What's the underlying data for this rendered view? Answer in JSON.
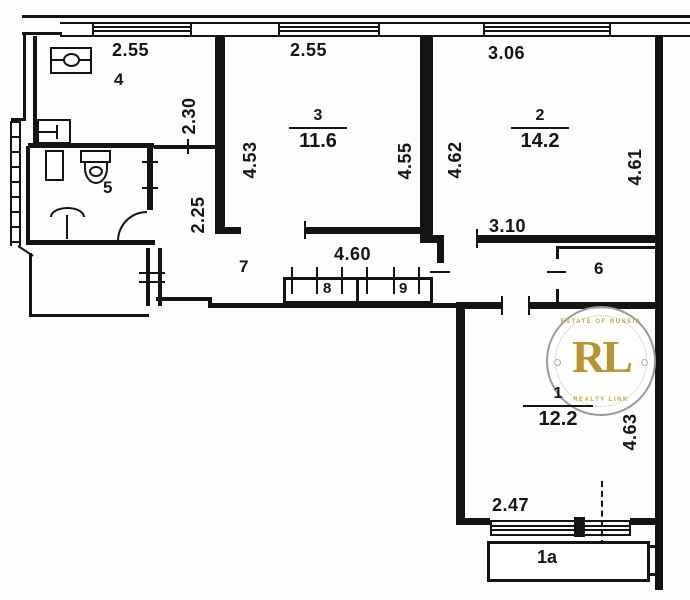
{
  "colors": {
    "ink": "#141414",
    "watermark_gold": "#b9952f"
  },
  "watermark": {
    "initials": "RL",
    "arc_top": "ESTATE OF RUSSIA",
    "arc_bottom": "REALTY LINK"
  },
  "rooms": {
    "r1": {
      "number": "1",
      "area": "12.2"
    },
    "r1a": {
      "number": "1a"
    },
    "r2": {
      "number": "2",
      "area": "14.2"
    },
    "r3": {
      "number": "3",
      "area": "11.6"
    },
    "r4": {
      "number": "4"
    },
    "r5": {
      "number": "5"
    },
    "r6": {
      "number": "6"
    },
    "r7": {
      "number": "7"
    },
    "r8": {
      "number": "8"
    },
    "r9": {
      "number": "9"
    }
  },
  "dimensions": {
    "room4_width": "2.55",
    "room4_depth": "2.30",
    "hall_depth": "2.25",
    "room3_width": "2.55",
    "room3_left": "4.53",
    "room3_right": "4.55",
    "room2_width": "3.06",
    "room2_left": "4.62",
    "room2_right": "4.61",
    "room2_bottom": "3.10",
    "hall_width": "4.60",
    "room1_right": "4.63",
    "room1_bottom": "2.47"
  }
}
